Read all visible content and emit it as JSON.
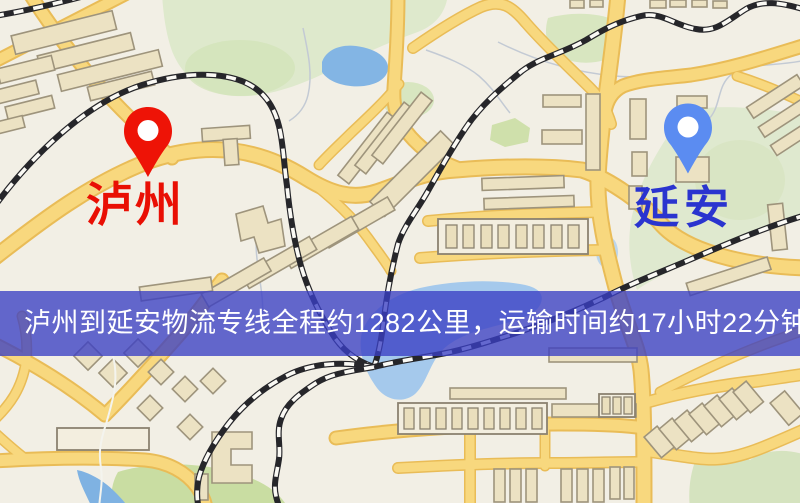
{
  "banner": {
    "text": "泸州到延安物流专线全程约1282公里，运输时间约17小时22分钟.",
    "background_color": "#3b3fc4",
    "text_color": "#ffffff"
  },
  "route": {
    "origin": "泸州",
    "destination": "延安",
    "distance_text": "约1282公里",
    "duration_text": "约17小时22分钟"
  },
  "markers": {
    "origin": {
      "label": "泸州",
      "pin_color": "#ee1306",
      "label_color": "#e90f04"
    },
    "destination": {
      "label": "延安",
      "pin_color": "#5b8cf1",
      "label_color": "#2a34cf"
    }
  },
  "map_colors": {
    "background": "#f2efe5",
    "road": "#f8d87e",
    "road_casing": "#e9bc57",
    "water": "#8ab9e6",
    "park": "#dce8cb",
    "railway": "#26262a"
  }
}
